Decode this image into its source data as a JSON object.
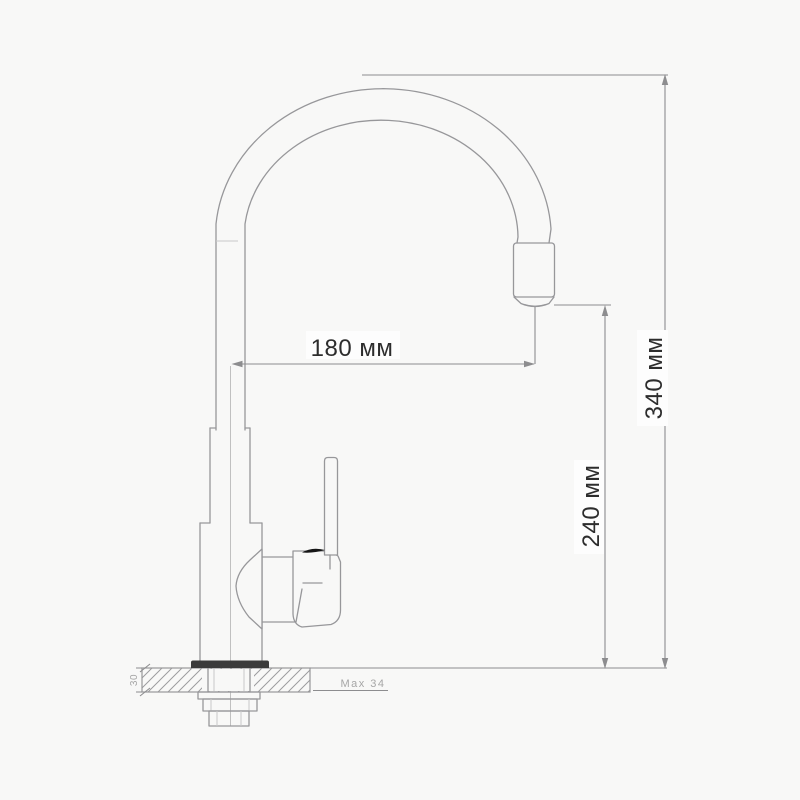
{
  "colors": {
    "bg": "#f8f8f7",
    "line": "#97979a",
    "dim": "#8d8d8f",
    "text_dark": "#2d2d2d",
    "text_light": "#a6a6a6",
    "flange": "#3b3b3b",
    "accent": "#161616",
    "label_bg": "#fdfdfd",
    "hatch": "#9c9c9e"
  },
  "drawing": {
    "dimensions": {
      "spout_reach": {
        "label": "180 мм",
        "orientation": "horizontal"
      },
      "spout_height": {
        "label": "240 мм",
        "orientation": "vertical"
      },
      "overall_height": {
        "label": "340 мм",
        "orientation": "vertical"
      },
      "deck_thickness": {
        "label": "30",
        "orientation": "vertical"
      },
      "max_mounting_thickness": {
        "label": "Max 34",
        "orientation": "horizontal"
      }
    }
  }
}
